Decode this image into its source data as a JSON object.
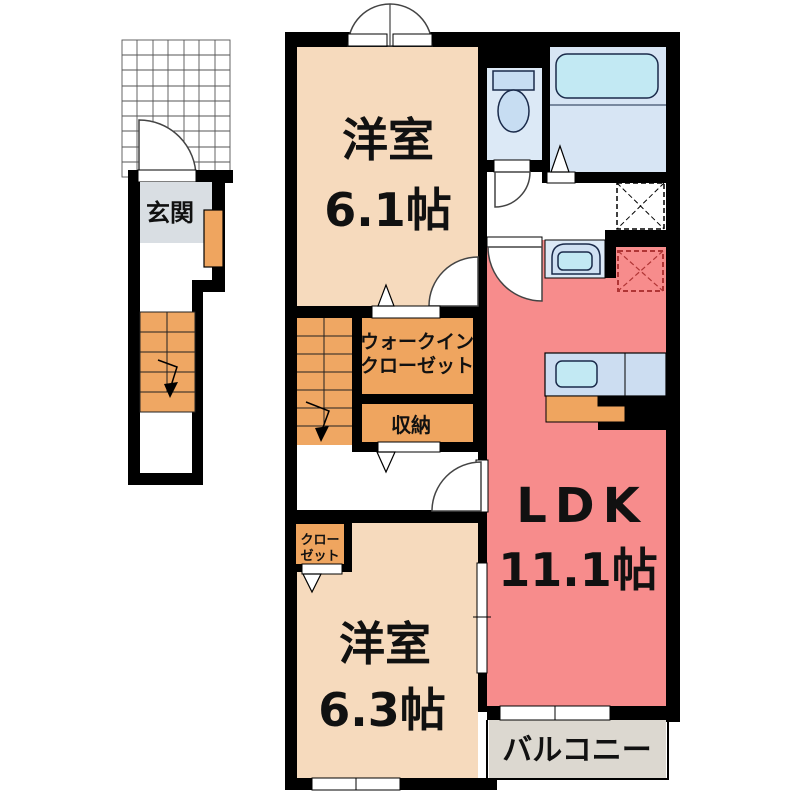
{
  "floorplan": {
    "rooms": {
      "bedroom1": {
        "name": "洋室",
        "size": "6.1帖"
      },
      "bedroom2": {
        "name": "洋室",
        "size": "6.3帖"
      },
      "ldk": {
        "name": "LDK",
        "size": "11.1帖"
      },
      "walk_in_closet": {
        "line1": "ウォークイン",
        "line2": "クローゼット"
      },
      "storage": {
        "label": "収納"
      },
      "closet": {
        "line1": "クロー",
        "line2": "ゼット"
      },
      "entrance": {
        "label": "玄関"
      },
      "balcony": {
        "label": "バルコニー"
      }
    },
    "colors": {
      "wall": "#000000",
      "bedroom": "#f6dabd",
      "ldk_red": "#f78c8c",
      "closet_orange": "#efa55f",
      "stairs_orange": "#efa763",
      "entrance_gray": "#d9dee3",
      "balcony_gray": "#dcd8d0",
      "toilet_blue": "#dce9f6",
      "bath_blue": "#d7e5f4",
      "fixture_cyan": "#c2e9f3",
      "counter_blue": "#ccddf1",
      "fridge_dash": "#b03535"
    }
  }
}
